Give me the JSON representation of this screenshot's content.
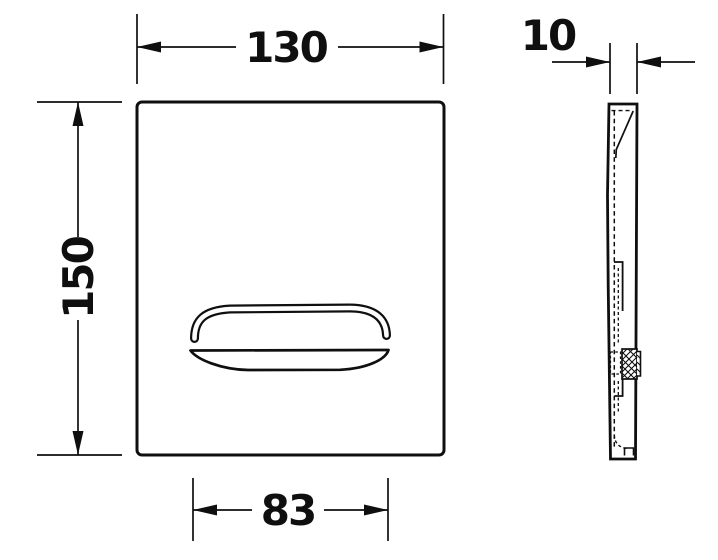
{
  "drawing": {
    "type": "technical-dimension-drawing",
    "views": {
      "front_view": {
        "dimensions": {
          "plate_width_mm": "130",
          "plate_height_mm": "150",
          "button_width_mm": "83"
        }
      },
      "side_view": {
        "dimensions": {
          "plate_depth_mm": "10"
        }
      }
    },
    "colors": {
      "line": "#0f0f0f",
      "background": "#ffffff"
    }
  }
}
